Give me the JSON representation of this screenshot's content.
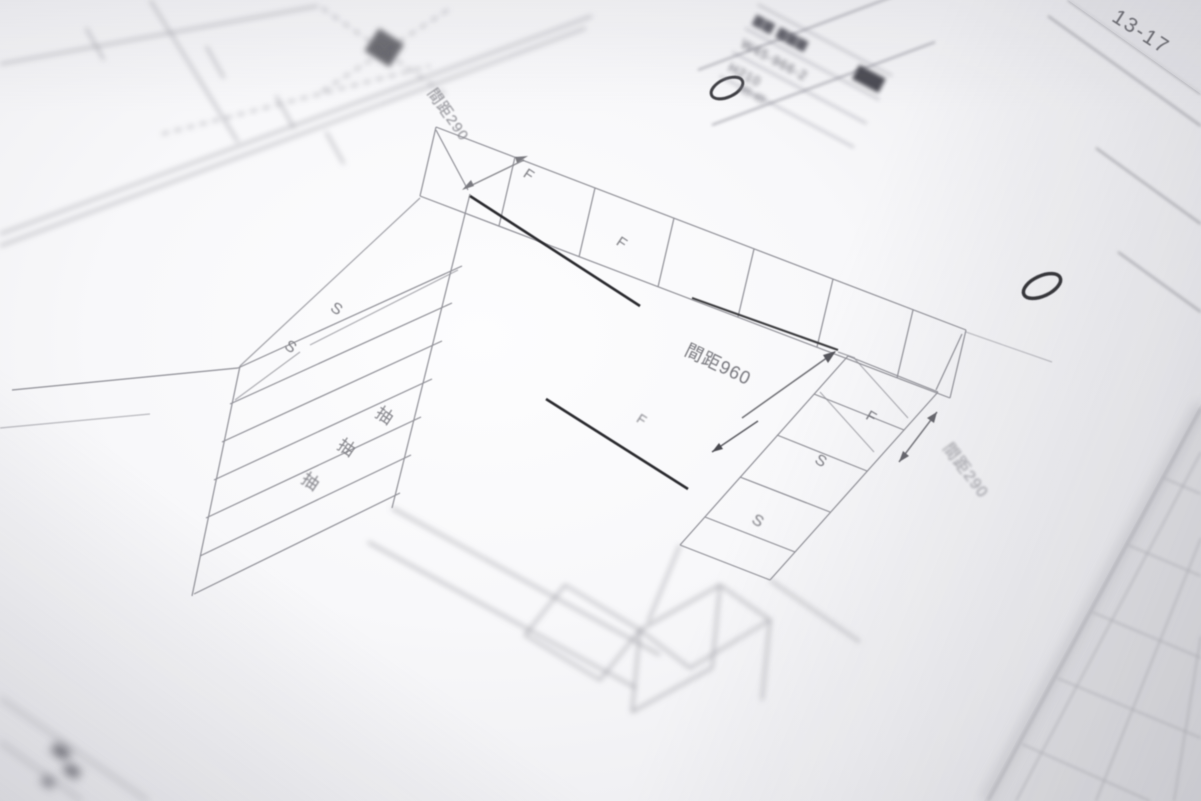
{
  "page": {
    "corner_code": "13-17"
  },
  "stamps": {
    "circle_top": "O",
    "circle_right": "O"
  },
  "title_block": {
    "row1": "▆▆ ▆▆▆",
    "row2": "W45-966-2",
    "row3": "H210",
    "note": "45-45"
  },
  "dimensions": {
    "top_spacing": "間距290",
    "center_spacing": "間距960",
    "right_spacing": "間距290"
  },
  "labels": {
    "f1": "F",
    "f2": "F",
    "f3": "F",
    "f4": "F",
    "s1": "S",
    "s2": "S",
    "s3": "S",
    "s4": "S",
    "drawer1": "抽",
    "drawer2": "抽",
    "drawer3": "抽"
  },
  "colors": {
    "paper": "#f8f8fa",
    "line": "#8f8f96",
    "dark_line": "#2a2a2f",
    "text": "#7e7e84"
  }
}
